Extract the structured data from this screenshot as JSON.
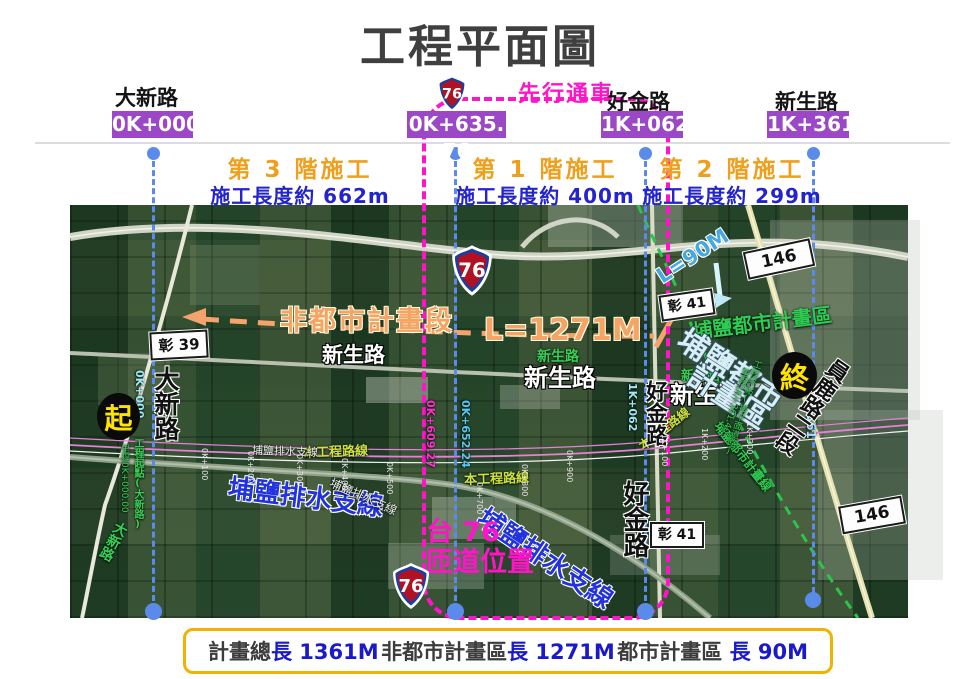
{
  "title": "工程平面圖",
  "colors": {
    "station_box": "#9b48c6",
    "magenta": "#ff14c8",
    "phase_orange": "#ef9f1c",
    "phase_blue": "#2424cc",
    "guide_blue": "#5b8bea",
    "summary_border": "#f0b400",
    "non_urban_orange": "#f4a464",
    "green_annotation": "#2ecc52"
  },
  "header": {
    "route_shield": "76",
    "pre_opening": "先行通車",
    "roads": [
      {
        "name": "大新路",
        "station": "0K+000"
      },
      {
        "name": "好金路",
        "station": "1K+062"
      },
      {
        "name": "新生路",
        "station": "1K+361"
      }
    ],
    "mid_station": "0K+635. 76"
  },
  "phases": [
    {
      "label": "第 3 階施工",
      "length": "施工長度約 662m"
    },
    {
      "label": "第 1 階施工",
      "length": "施工長度約 400m"
    },
    {
      "label": "第 2 階施工",
      "length": "施工長度約 299m"
    }
  ],
  "map": {
    "signs": {
      "chang39": "彰 39",
      "chang41": "彰 41",
      "r146": "146"
    },
    "markers": {
      "start": "起",
      "end": "終"
    },
    "labels": {
      "daxin_rd": "大新路",
      "non_urban_segment": "非都市計畫段",
      "l1271": "L=1271M",
      "l90": "L=90M",
      "xinsheng_rd": "新生路",
      "project_route": "本工程路線",
      "drainage": "埔鹽排水支線",
      "ramp_line1": "台 76",
      "ramp_line2": "匝道位置",
      "haojin_rd": "好金路",
      "puyan_urban_area": "埔鹽都市計畫區",
      "puyan_urban_big1": "埔鹽都市",
      "puyan_urban_big2": "計畫區",
      "puyan_urban_line": "埔鹽都市計畫線",
      "yuanlu_rd": "員鹿路二段",
      "start_note": "工程起點(大新路)",
      "start_note2": "里程0K+000.00",
      "end_note": "工程終點(接平面道路)",
      "end_note2": "里程1K+361.40",
      "sta_0k000": "0K+000",
      "sta_1k062": "1K+062",
      "sta_1k361": "1K+361",
      "sta_0k609": "0K+609.27",
      "sta_0k652": "0K+652.24",
      "ticks": [
        "0K+100",
        "0K+200",
        "0K+300",
        "0K+400",
        "0K+500",
        "0K+700",
        "0K+800",
        "0K+900",
        "1K+100",
        "1K+200",
        "1K+300"
      ]
    }
  },
  "summary": {
    "items": [
      {
        "label": "計畫總",
        "value": "長 1361M"
      },
      {
        "label": "非都市計畫區",
        "value": "長 1271M"
      },
      {
        "label": "都市計畫區 ",
        "value": "長 90M"
      }
    ]
  }
}
